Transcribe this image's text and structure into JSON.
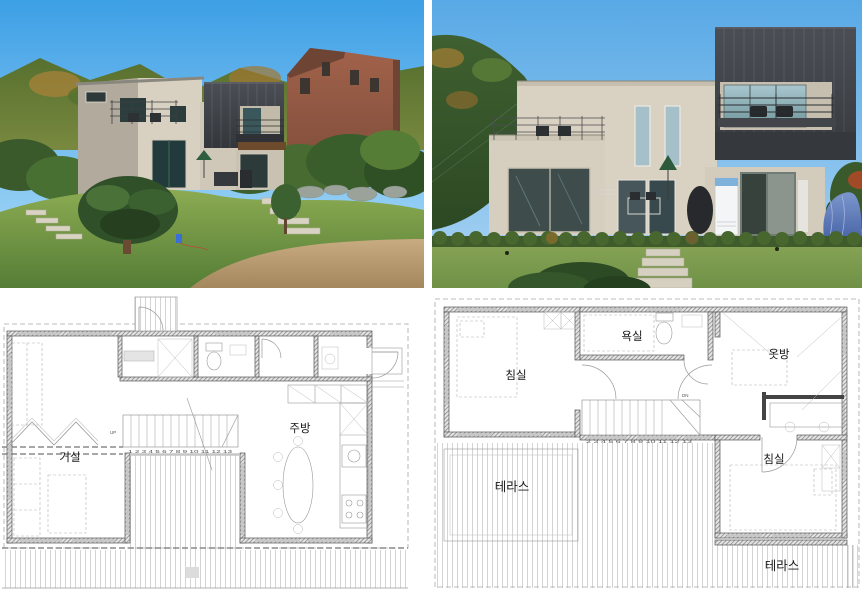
{
  "meta": {
    "title": "House exterior photos with first and second floor plans"
  },
  "photos": {
    "left": {
      "name": "hillside-view"
    },
    "right": {
      "name": "front-view"
    }
  },
  "plans": {
    "first_floor": {
      "rooms": [
        {
          "label": "거실"
        },
        {
          "label": "주방"
        }
      ],
      "stair_numbers": "1 2 3 4 5 6 7 8 9 10 11 12 13",
      "up_label": "UP"
    },
    "second_floor": {
      "rooms": [
        {
          "label": "침실"
        },
        {
          "label": "욕실"
        },
        {
          "label": "옷방"
        },
        {
          "label": "침실"
        },
        {
          "label": "테라스"
        },
        {
          "label": "테라스"
        }
      ],
      "stair_numbers": "2 3 4 5 6 7 8 9 10 11 12 13",
      "dn_label": "DN"
    }
  },
  "colors": {
    "sky_blue": "#58a9e6",
    "house_beige": "#d8d1c2",
    "metal_charcoal": "#3a3e44",
    "brick_red": "#9a5f48",
    "grass_green": "#7da147",
    "plan_line": "#777777",
    "deck_stripe": "#d4d4d4",
    "label_text": "#1a1a1a"
  }
}
